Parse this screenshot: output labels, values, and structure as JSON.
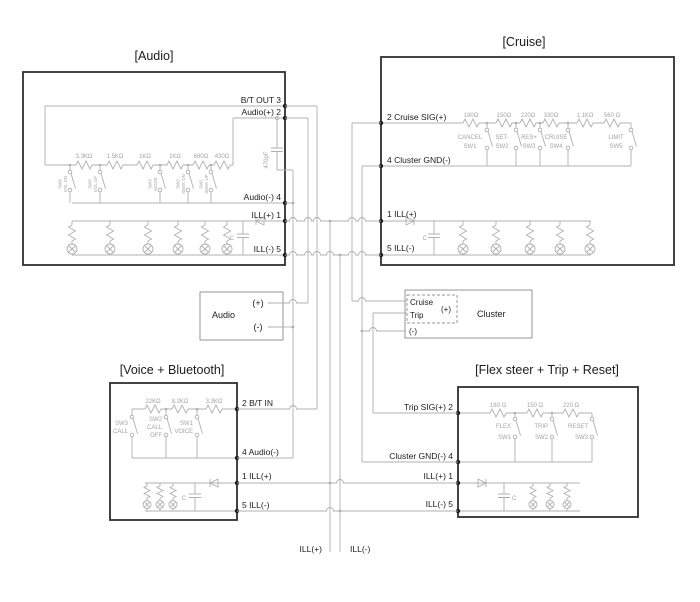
{
  "audio": {
    "title": "[Audio]",
    "pins": {
      "p3": "B/T OUT 3",
      "p2": "Audio(+) 2",
      "p4": "Audio(-) 4",
      "p1": "ILL(+) 1",
      "p5": "ILL(-) 5"
    },
    "resistors": [
      "3.3KΩ",
      "1.5KΩ",
      "1KΩ",
      "1KΩ",
      "680Ω",
      "430Ω"
    ],
    "switches": [
      [
        "SW6",
        "VOL DN"
      ],
      [
        "SW5",
        "VOL UP"
      ],
      [
        "SW3",
        "MODE"
      ],
      [
        "SW2",
        "SEEK DN"
      ],
      [
        "SW1",
        "SEEK UP"
      ]
    ],
    "signal_cap": "470pF",
    "ill_cap": "C"
  },
  "cruise": {
    "title": "[Cruise]",
    "pins": {
      "p2": "2 Cruise SIG(+)",
      "p4": "4 Cluster GND(-)",
      "p1": "1 ILL(+)",
      "p5": "5 ILL(-)"
    },
    "resistors": [
      "180Ω",
      "150Ω",
      "220Ω",
      "330Ω",
      "1.1KΩ",
      "560 Ω"
    ],
    "switches": [
      [
        "CANCEL",
        "SW1"
      ],
      [
        "SET-",
        "SW2"
      ],
      [
        "RES+",
        "SW3"
      ],
      [
        "CRUISE",
        "SW4"
      ],
      [
        "LIMIT",
        "SW5"
      ]
    ],
    "ill_cap": "C"
  },
  "voice": {
    "title": "[Voice + Bluetooth]",
    "pins": {
      "p2": "2 B/T IN",
      "p4": "4 Audio(-)",
      "p1": "1 ILL(+)",
      "p5": "5 ILL(-)"
    },
    "resistors": [
      "22KΩ",
      "8.2KΩ",
      "3.3KΩ"
    ],
    "switches": [
      [
        "SW3",
        "CALL"
      ],
      [
        "SW2",
        "CALL",
        "OFF"
      ],
      [
        "SW1",
        "VOICE"
      ]
    ],
    "ill_cap": "C"
  },
  "flex": {
    "title": "[Flex steer + Trip + Reset]",
    "pins": {
      "p2": "Trip SIG(+) 2",
      "p4": "Cluster GND(-) 4",
      "p1": "ILL(+) 1",
      "p5": "ILL(-) 5"
    },
    "resistors": [
      "180 Ω",
      "150 Ω",
      "220 Ω"
    ],
    "switches": [
      [
        "FLEX",
        "SW1"
      ],
      [
        "TRIP",
        "SW2"
      ],
      [
        "RESET",
        "SW3"
      ]
    ],
    "ill_cap": "C"
  },
  "audio_connector": {
    "label": "Audio",
    "pos": "(+)",
    "neg": "(-)"
  },
  "cluster": {
    "label": "Cluster",
    "cruise": "Cruise",
    "trip": "Trip",
    "pos": "(+)",
    "neg": "(-)"
  },
  "leads": {
    "ill_pos": "ILL(+)",
    "ill_neg": "ILL(-)"
  },
  "colors": {
    "wire": "#b0b0b0",
    "box_border": "#2f2f2f",
    "text": "#1c1c1c",
    "component_text": "#a4a4a4",
    "background": "#ffffff"
  }
}
